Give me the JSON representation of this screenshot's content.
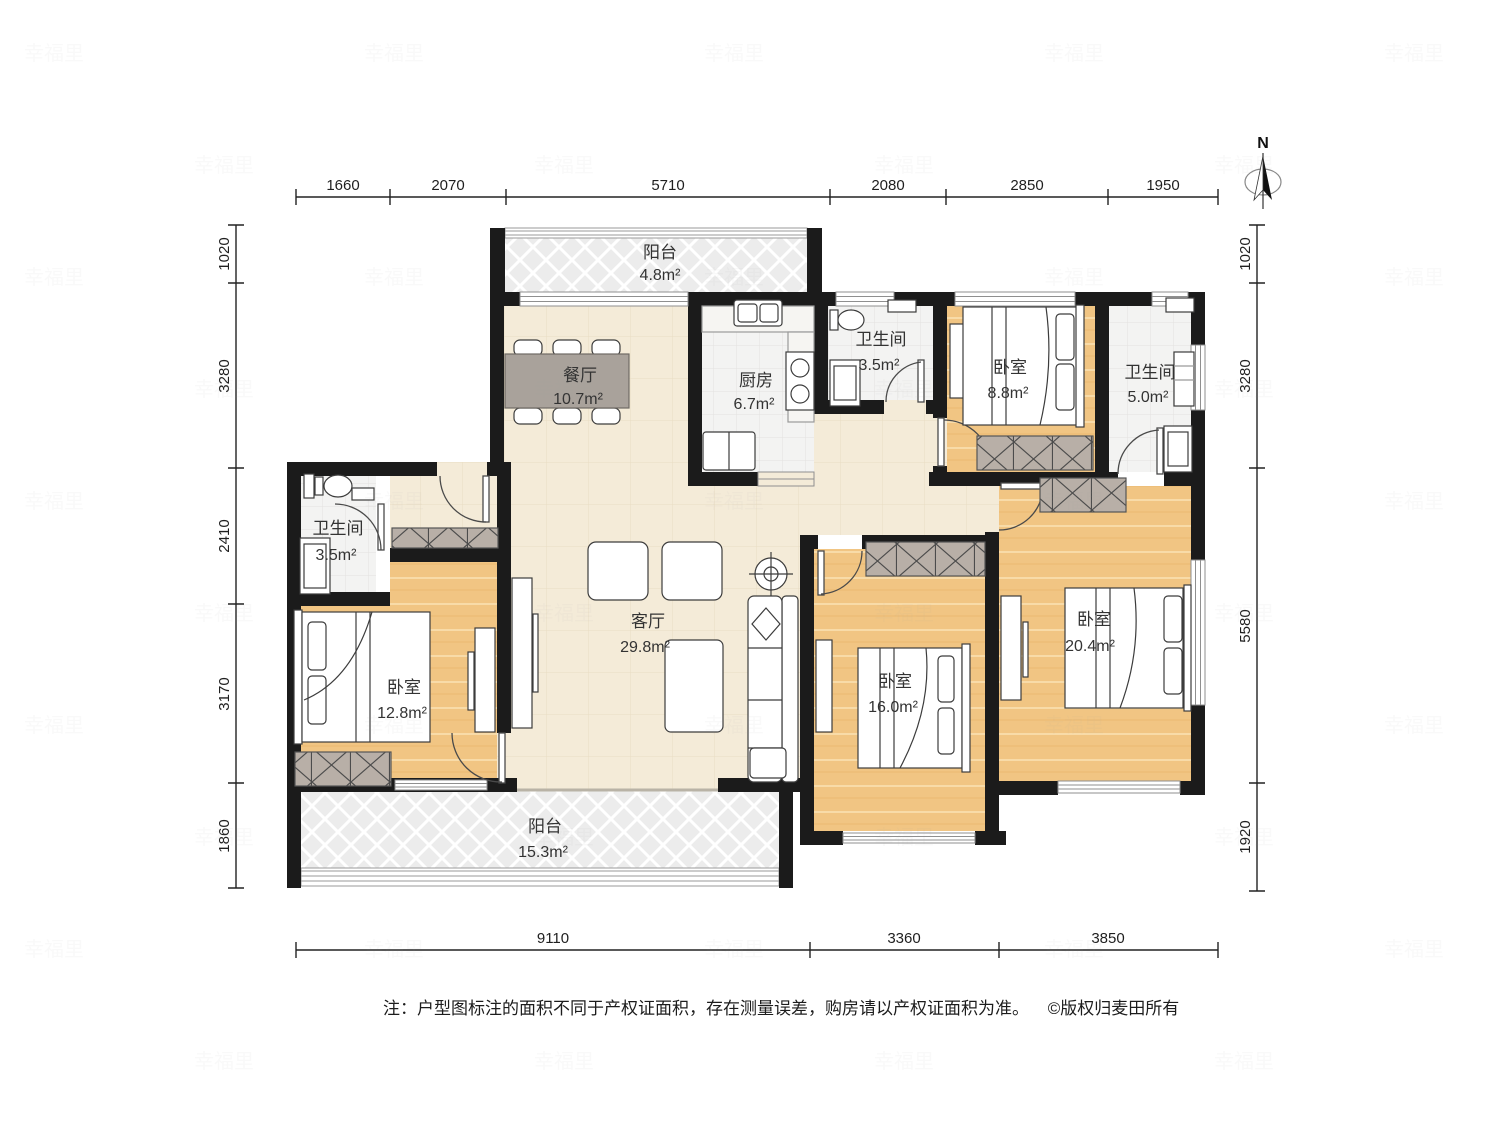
{
  "compass": {
    "label": "N"
  },
  "dimensions": {
    "top": [
      "1660",
      "2070",
      "5710",
      "2080",
      "2850",
      "1950"
    ],
    "bottom": [
      "9110",
      "3360",
      "3850"
    ],
    "left": [
      "1020",
      "3280",
      "2410",
      "3170",
      "1860"
    ],
    "right": [
      "1020",
      "3280",
      "5580",
      "1920"
    ]
  },
  "rooms": {
    "balcony_top": {
      "name": "阳台",
      "area": "4.8m²"
    },
    "dining": {
      "name": "餐厅",
      "area": "10.7m²"
    },
    "kitchen": {
      "name": "厨房",
      "area": "6.7m²"
    },
    "bath_mid": {
      "name": "卫生间",
      "area": "3.5m²"
    },
    "bedroom_tr": {
      "name": "卧室",
      "area": "8.8m²"
    },
    "bath_tr": {
      "name": "卫生间",
      "area": "5.0m²"
    },
    "bath_left": {
      "name": "卫生间",
      "area": "3.5m²"
    },
    "living": {
      "name": "客厅",
      "area": "29.8m²"
    },
    "bedroom_left": {
      "name": "卧室",
      "area": "12.8m²"
    },
    "bedroom_mid": {
      "name": "卧室",
      "area": "16.0m²"
    },
    "bedroom_right": {
      "name": "卧室",
      "area": "20.4m²"
    },
    "balcony_bottom": {
      "name": "阳台",
      "area": "15.3m²"
    }
  },
  "note": {
    "text": "注：户型图标注的面积不同于产权证面积，存在测量误差，购房请以产权证面积为准。",
    "copyright": "©版权归麦田所有"
  },
  "watermark": {
    "text": "幸福里"
  },
  "colors": {
    "wall": "#1b1b1b",
    "bedroom_floor": "#f1c583",
    "living_floor": "#f4ebd8",
    "tile_floor": "#f4f4f3",
    "balcony_floor": "#ececec",
    "wardrobe": "#b8afa7",
    "dining_table": "#a9a29b"
  }
}
